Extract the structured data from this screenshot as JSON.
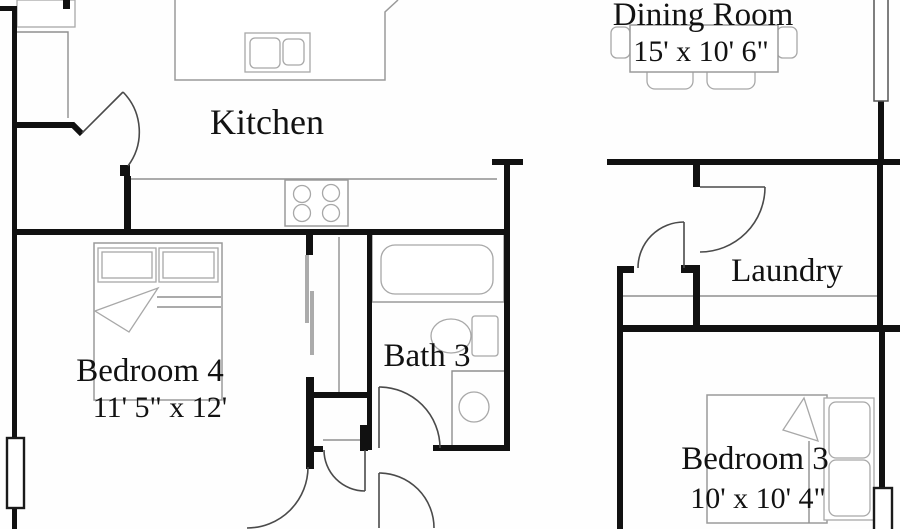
{
  "plan_title": "Residential floor plan (partial view)",
  "rooms": [
    {
      "id": "kitchen",
      "name": "Kitchen",
      "dims": ""
    },
    {
      "id": "dining-room",
      "name": "Dining Room",
      "dims": "15' x 10' 6\""
    },
    {
      "id": "laundry",
      "name": "Laundry",
      "dims": ""
    },
    {
      "id": "bath-3",
      "name": "Bath 3",
      "dims": ""
    },
    {
      "id": "bedroom-4",
      "name": "Bedroom 4",
      "dims": "11' 5\" x 12'"
    },
    {
      "id": "bedroom-3",
      "name": "Bedroom 3",
      "dims": "10' x 10' 4\""
    }
  ],
  "fixtures": [
    "refrigerator",
    "kitchen-counter",
    "kitchen-island",
    "island-sink",
    "cooktop",
    "dining-table",
    "dining-chairs",
    "bathtub",
    "toilet",
    "vanity-sink",
    "bed-queen",
    "bed-full",
    "closet-sliding-doors",
    "washer-dryer-line"
  ],
  "colors": {
    "wall": "#111111",
    "fixture_line": "#9a9a9a",
    "door_line": "#4a4a4a",
    "text": "#121212",
    "background": "#ffffff"
  }
}
